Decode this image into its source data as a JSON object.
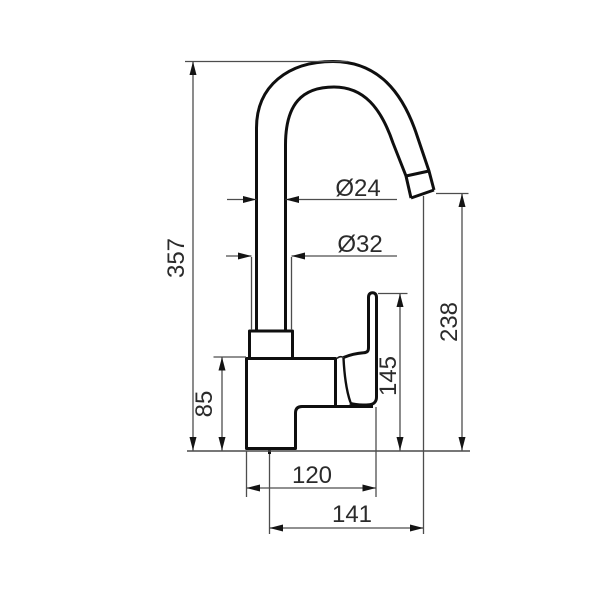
{
  "drawing": {
    "title": "Kitchen faucet technical drawing - side view",
    "units": "mm",
    "dims": {
      "height_overall": "357",
      "height_body": "85",
      "height_handle": "145",
      "height_spout_outlet": "238",
      "depth_body": "120",
      "reach_spout": "141",
      "dia_spout_pipe": "Ø24",
      "dia_base_collar": "Ø32"
    },
    "colors": {
      "object_line": "#0f0f0f",
      "dimension_line": "#4d4d4d",
      "text": "#2b2b2b",
      "background": "#ffffff"
    }
  }
}
